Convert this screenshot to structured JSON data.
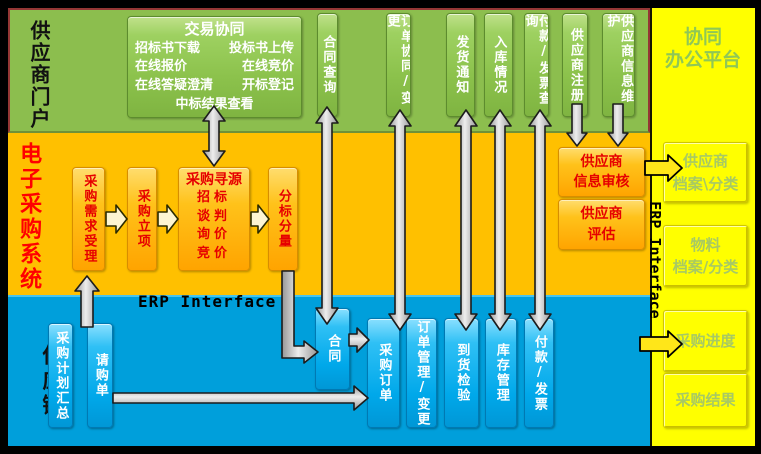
{
  "colors": {
    "portal_bg": "#8cbe4e",
    "eproc_bg": "#ffc000",
    "chain_bg": "#009fdb",
    "collab_bg": "#ffff00",
    "portal_border": "#953735",
    "eproc_text": "#ff0000",
    "box_text_red": "#e60000",
    "collab_text": "#8fc756",
    "arrow_gray": "#cccccc",
    "arrow_yellow": "#ffe619"
  },
  "regions": {
    "supplier_portal": "供应商门户",
    "eprocurement": "电子采购系统",
    "supply_chain": "供应链",
    "collab_l1": "协同",
    "collab_l2": "办公平台"
  },
  "portal": {
    "trade": {
      "title": "交易协同",
      "rows": [
        [
          "招标书下载",
          "投标书上传"
        ],
        [
          "在线报价",
          "在线竞价"
        ],
        [
          "在线答疑澄清",
          "开标登记"
        ]
      ],
      "last": "中标结果查看"
    },
    "boxes": [
      "合同查询",
      "订单协同/变更",
      "发货通知",
      "入库情况",
      "付款/发票查询",
      "供应商注册",
      "供应商信息维护"
    ]
  },
  "eproc": {
    "flow": [
      "采购需求受理",
      "采购立项"
    ],
    "sourcing": {
      "title": "采购寻源",
      "items": [
        "招标",
        "谈判",
        "询价",
        "竞价"
      ]
    },
    "split": "分标分量",
    "review": {
      "l1": "供应商",
      "l2": "信息审核"
    },
    "evaluate": {
      "l1": "供应商",
      "l2": "评估"
    }
  },
  "erp": {
    "horizontal": "ERP Interface",
    "vertical": "ERP Interface"
  },
  "supply": {
    "boxes": [
      "采购计划汇总",
      "请购单",
      "合同",
      "采购订单",
      "订单管理/变更",
      "到货检验",
      "库存管理",
      "付款/发票"
    ]
  },
  "collab": {
    "boxes": [
      {
        "l1": "供应商",
        "l2": "档案\\分类"
      },
      {
        "l1": "物料",
        "l2": "档案/分类"
      },
      {
        "l1": "采购进度",
        "l2": ""
      },
      {
        "l1": "采购结果",
        "l2": ""
      }
    ]
  }
}
